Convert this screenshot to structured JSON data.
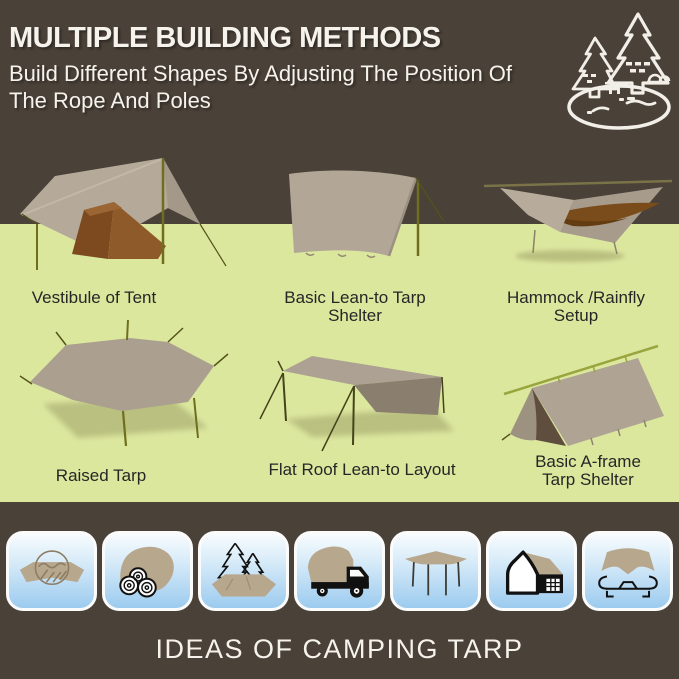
{
  "header": {
    "title": "MULTIPLE BUILDING METHODS",
    "subtitle_line1": "Build Different Shapes By Adjusting The Position Of",
    "subtitle_line2": "The Rope And Poles",
    "logo_icon": "pine-trees-camp-pond-icon"
  },
  "methods": [
    {
      "name": "vestibule-of-tent",
      "label_line1": "Vestibule of Tent",
      "label_line2": ""
    },
    {
      "name": "basic-lean-to-tarp-shelter",
      "label_line1": "Basic Lean-to Tarp",
      "label_line2": "Shelter"
    },
    {
      "name": "hammock-rainfly-setup",
      "label_line1": "Hammock /Rainfly",
      "label_line2": "Setup"
    },
    {
      "name": "raised-tarp",
      "label_line1": "Raised Tarp",
      "label_line2": ""
    },
    {
      "name": "flat-roof-lean-to-layout",
      "label_line1": "Flat Roof Lean-to Layout",
      "label_line2": ""
    },
    {
      "name": "basic-a-frame-tarp-shelter",
      "label_line1": "Basic A-frame",
      "label_line2": "Tarp Shelter"
    }
  ],
  "footer": {
    "title": "IDEAS OF CAMPING TARP",
    "icons": [
      "rain-cover-tarp-icon",
      "firewood-cover-tarp-icon",
      "ground-sheet-tarp-icon",
      "truck-cargo-cover-tarp-icon",
      "canopy-tarp-icon",
      "tent-shelter-tarp-icon",
      "car-cover-tarp-icon"
    ]
  },
  "colors": {
    "background_brown": "#4a4138",
    "meadow_green": "#dce79e",
    "tarp_tan": "#b3a897",
    "tent_brown": "#8f5a2a",
    "pole_olive": "#6f6e1e",
    "tile_blue": "#9ccbef",
    "text_white": "#f6f3ed",
    "text_black": "#262626"
  }
}
